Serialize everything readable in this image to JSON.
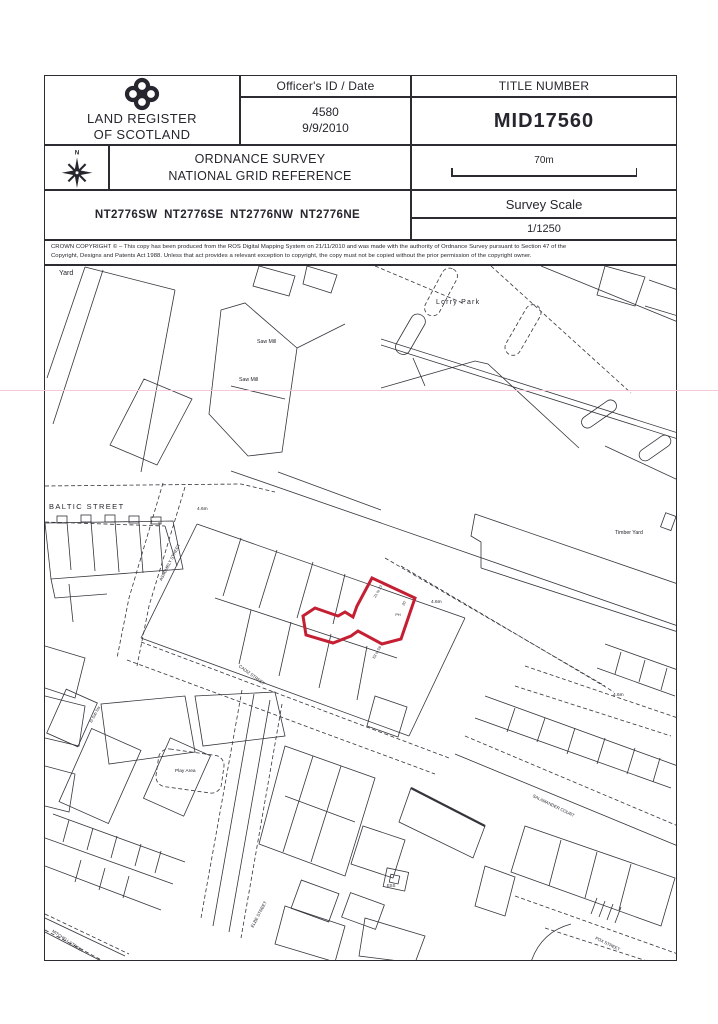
{
  "header": {
    "logo_icon": "ros-quatrefoil-knot-logo",
    "org_line1": "LAND REGISTER",
    "org_line2": "OF SCOTLAND",
    "officer_label": "Officer's ID / Date",
    "officer_id": "4580",
    "officer_date": "9/9/2010",
    "title_label": "TITLE NUMBER",
    "title_number": "MID17560",
    "compass_icon": "compass-rose-north",
    "compass_north": "N",
    "os_line1": "ORDNANCE SURVEY",
    "os_line2": "NATIONAL GRID REFERENCE",
    "scale_bar_label": "70m",
    "survey_scale_label": "Survey Scale",
    "survey_scale_value": "1/1250",
    "grid_refs": "NT2776SW NT2776SE NT2776NW NT2776NE"
  },
  "copyright": {
    "line1": "CROWN COPYRIGHT © – This copy has been produced from the ROS Digital Mapping System on  21/11/2010  and was made with the authority of Ordnance Survey pursuant to Section 47 of the",
    "line2": "Copyright, Designs and Patents Act 1988. Unless that act provides a relevant exception to copyright, the copy must not be copied without the prior permission of the copyright owner."
  },
  "map": {
    "labels": [
      {
        "text": "Yard"
      },
      {
        "text": "Lorry Park"
      },
      {
        "text": "Saw Mill"
      },
      {
        "text": "Saw Mill"
      },
      {
        "text": "BALTIC STREET"
      },
      {
        "text": "4.6m"
      },
      {
        "text": "ASSEMBLY STREET"
      },
      {
        "text": "Timber Yard"
      },
      {
        "text": "4.6m"
      },
      {
        "text": "21 to 23"
      },
      {
        "text": "20"
      },
      {
        "text": "PH"
      },
      {
        "text": "53 to 59"
      },
      {
        "text": "CADIZ STREET"
      },
      {
        "text": "El Sub Sta"
      },
      {
        "text": "Play Area"
      },
      {
        "text": "SALAMANDER COURT"
      },
      {
        "text": "ESS"
      },
      {
        "text": "ELBE STREET"
      },
      {
        "text": "MITCHELL STREET"
      },
      {
        "text": "FOX STREET"
      },
      {
        "text": "4.6m"
      }
    ],
    "title_boundary_for": "MID17560"
  },
  "colors": {
    "boundary_red": "#c41f33",
    "map_line": "#34343c",
    "fold_line_pink": "#f4c6d5",
    "ink": "#26262e"
  }
}
